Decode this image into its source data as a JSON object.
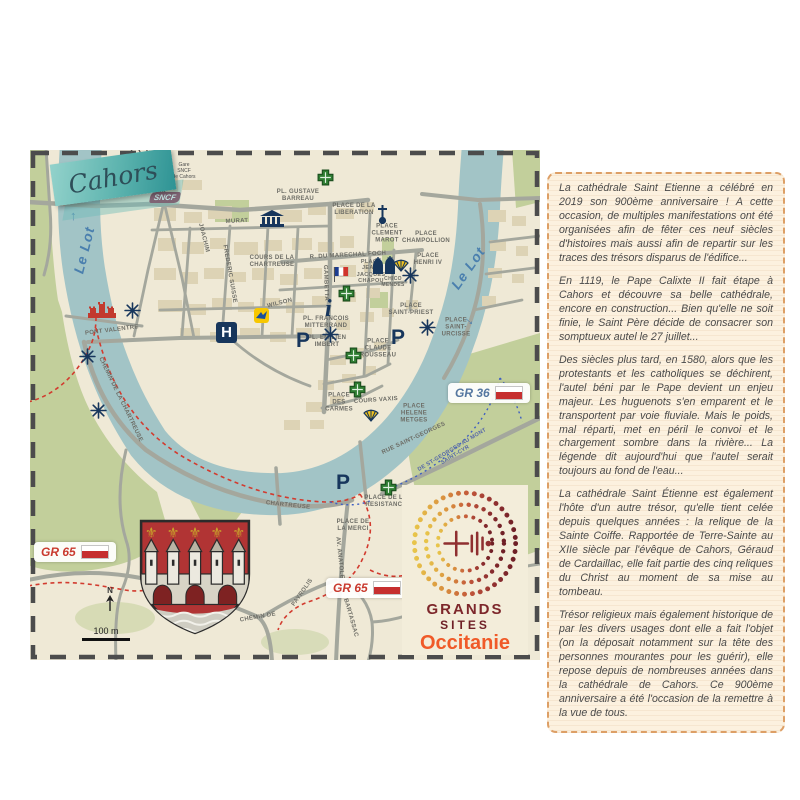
{
  "banner": {
    "title": "Cahors"
  },
  "station": {
    "logo": "SNCF",
    "label": "Gare\nSNCF\nde Cahors"
  },
  "river": {
    "name": "Le Lot",
    "arrow_up": "↑",
    "arrow_down": "→"
  },
  "letters": {
    "hospital": "H",
    "parking": "P",
    "info": "i"
  },
  "gr_markers": [
    {
      "label": "GR 36",
      "style": "blue"
    },
    {
      "label": "GR 65",
      "style": "red"
    },
    {
      "label": "GR 65",
      "style": "red"
    }
  ],
  "scale": {
    "north": "N",
    "distance": "100 m"
  },
  "labels": [
    {
      "text": "PL. GUSTAVE\nBARREAU",
      "x": 268,
      "y": 46
    },
    {
      "text": "PLACE DE LA\nLIBERATION",
      "x": 324,
      "y": 60
    },
    {
      "text": "PLACE\nCLEMENT\nMAROT",
      "x": 357,
      "y": 84
    },
    {
      "text": "PLACE\nCHAMPOLLION",
      "x": 396,
      "y": 88
    },
    {
      "text": "R. DU MARECHAL FOCH",
      "x": 318,
      "y": 106,
      "rot": -3
    },
    {
      "text": "PLACE\nJEAN-\nJACQUES\nCHAPOU",
      "x": 341,
      "y": 122,
      "size": 5.5
    },
    {
      "text": "PLACE\nHENRI IV",
      "x": 398,
      "y": 110
    },
    {
      "text": "COURS DE LA\nCHARTREUSE",
      "x": 242,
      "y": 112
    },
    {
      "text": "CHICO\nMENDES",
      "x": 363,
      "y": 133,
      "size": 5
    },
    {
      "text": "PL. FRANCOIS\nMITTERRAND",
      "x": 296,
      "y": 173
    },
    {
      "text": "PL. EMILIEN\nIMBERT",
      "x": 297,
      "y": 192
    },
    {
      "text": "PLACE\nCLAUDE\nROUSSEAU",
      "x": 348,
      "y": 199
    },
    {
      "text": "PLACE\nSAINT-PRIEST",
      "x": 381,
      "y": 160
    },
    {
      "text": "PLACE\nSAINT-\nURCISSE",
      "x": 426,
      "y": 178
    },
    {
      "text": "PLACE\nDES\nCARMES",
      "x": 309,
      "y": 253
    },
    {
      "text": "COURS VAXIS",
      "x": 346,
      "y": 251,
      "rot": -4
    },
    {
      "text": "PLACE\nHELENE\nMETGES",
      "x": 384,
      "y": 264
    },
    {
      "text": "PLACE DE LA\nRESISTANCE",
      "x": 356,
      "y": 352
    },
    {
      "text": "PLACE DE\nLA MERCI",
      "x": 323,
      "y": 376
    },
    {
      "text": "PONT  VALENTRE",
      "x": 82,
      "y": 181,
      "rot": -7
    },
    {
      "text": "CHEMIN  DE  LA  CHARTREUSE",
      "x": 90,
      "y": 250,
      "rot": 64
    },
    {
      "text": "CHARTREUSE",
      "x": 258,
      "y": 356,
      "rot": 6
    },
    {
      "text": "RUE  SAINT-GEORGES",
      "x": 384,
      "y": 289,
      "rot": -25
    },
    {
      "text": "AV. ANATOLE",
      "x": 309,
      "y": 408,
      "rot": 84
    },
    {
      "text": "CHEMIN  DE",
      "x": 228,
      "y": 468,
      "rot": -10
    },
    {
      "text": "PAYROLIS",
      "x": 273,
      "y": 443,
      "rot": -55
    },
    {
      "text": "BARTASSAC",
      "x": 320,
      "y": 468,
      "rot": 74
    },
    {
      "text": "DE ST-GEORGES AU MONT SAINT-CYR",
      "x": 424,
      "y": 303,
      "rot": -31,
      "size": 5.5,
      "color": "#5566a8"
    },
    {
      "text": "MURAT",
      "x": 207,
      "y": 72,
      "rot": -3
    },
    {
      "text": "WILSON",
      "x": 250,
      "y": 154,
      "rot": -14
    },
    {
      "text": "GAMBETTA",
      "x": 295,
      "y": 133,
      "rot": 88
    },
    {
      "text": "JOACHIM",
      "x": 173,
      "y": 88,
      "rot": 76
    },
    {
      "text": "FREDERIC SUISSE",
      "x": 199,
      "y": 124,
      "rot": 80
    }
  ],
  "logo": {
    "line1": "GRANDS",
    "line2": "SITES",
    "line3": "Occitanie"
  },
  "panel": {
    "paragraphs": [
      "La cathédrale Saint Etienne a célébré en 2019 son 900ème anniversaire ! A cette occasion, de multiples manifestations ont été organisées afin de fêter ces neuf siècles d'histoires mais aussi afin de repartir sur les traces des trésors disparus de l'édifice...",
      "En 1119, le Pape Calixte II fait étape à Cahors et découvre sa belle cathédrale, encore en construction... Bien qu'elle ne soit finie, le Saint Père décide de consacrer son somptueux autel le 27 juillet...",
      "Des siècles plus tard, en 1580, alors que les protestants et les catholiques se déchirent, l'autel béni par le Pape devient un enjeu majeur. Les huguenots s'en emparent et le transportent par voie fluviale. Mais le poids, mal réparti, met en péril le convoi et le chargement sombre dans la rivière... La légende dit aujourd'hui que l'autel serait toujours au fond de l'eau...",
      "La cathédrale Saint Étienne est également l'hôte d'un autre trésor, qu'elle tient celée depuis quelques années : la relique de la Sainte Coiffe. Rapportée de Terre-Sainte au XIIe siècle par l'évêque de Cahors, Géraud de Cardaillac, elle fait partie des cinq reliques du Christ au moment de sa mise au tombeau.",
      "Trésor religieux mais également historique de par les divers usages dont elle a fait l'objet (on la déposait notamment sur la tête des personnes mourantes pour les guérir), elle repose depuis de nombreuses années dans la cathédrale de Cahors. Ce 900ème anniversaire a été l'occasion de la remettre à la vue de tous."
    ]
  },
  "colors": {
    "river": "#a2c4c6",
    "map_bg": "#efe9d6",
    "building": "#ddd3b5",
    "park": "#c2cf9b",
    "navy": "#17365c",
    "pharmacy_green": "#2f7d32",
    "gr_red": "#c62f2f",
    "banner_teal": "#57b0ad",
    "panel_bg": "#fcf1df",
    "panel_border": "#dd9f66",
    "shield_red": "#b13434",
    "occitanie_orange": "#f05a28"
  }
}
